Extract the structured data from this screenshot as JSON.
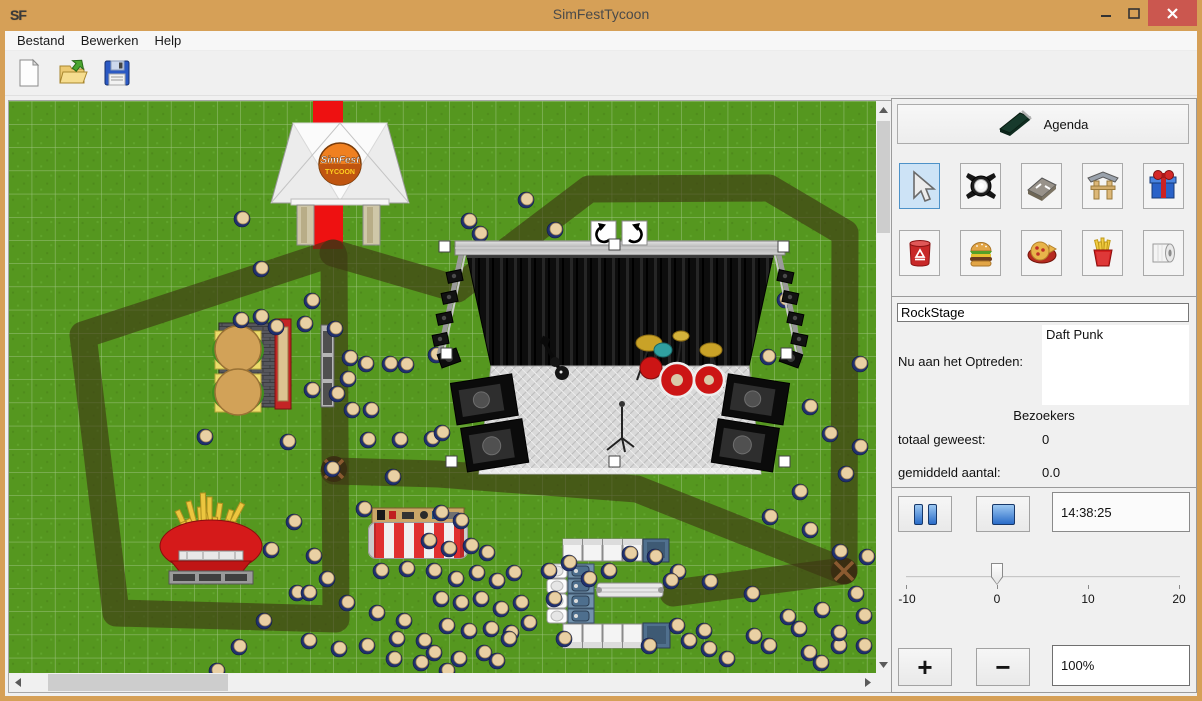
{
  "window": {
    "title": "SimFestTycoon",
    "icon_text": "SF"
  },
  "menu": {
    "items": [
      "Bestand",
      "Bewerken",
      "Help"
    ]
  },
  "toolbar": {
    "buttons": [
      {
        "name": "new-file",
        "icon": "new-document-icon"
      },
      {
        "name": "open-file",
        "icon": "open-folder-icon"
      },
      {
        "name": "save-file",
        "icon": "save-floppy-icon"
      }
    ]
  },
  "panel": {
    "agenda_label": "Agenda",
    "tools": [
      {
        "name": "select",
        "icon": "cursor-icon",
        "selected": true
      },
      {
        "name": "stage-light",
        "icon": "spotlight-icon",
        "selected": false
      },
      {
        "name": "road",
        "icon": "road-tile-icon",
        "selected": false
      },
      {
        "name": "entrance-gate",
        "icon": "gate-icon",
        "selected": false
      },
      {
        "name": "gift",
        "icon": "gift-icon",
        "selected": false
      }
    ],
    "items": [
      {
        "name": "trash-can",
        "icon": "trash-can-icon",
        "selected": false
      },
      {
        "name": "burger-stand",
        "icon": "burger-icon",
        "selected": false
      },
      {
        "name": "pizza-stand",
        "icon": "pizza-icon",
        "selected": false
      },
      {
        "name": "fries-stand",
        "icon": "fries-icon",
        "selected": false
      },
      {
        "name": "toilet",
        "icon": "toilet-roll-icon",
        "selected": false
      }
    ],
    "stage_name_value": "RockStage",
    "now_performing_label": "Nu aan het Optreden:",
    "now_performing_value": "Daft Punk",
    "visitors_header": "Bezoekers",
    "total_label": "totaal geweest:",
    "total_value": "0",
    "average_label": "gemiddeld aantal:",
    "average_value": "0.0",
    "time_value": "14:38:25",
    "slider": {
      "min": -10,
      "max": 20,
      "value": 0,
      "tick_labels": [
        "-10",
        "0",
        "10",
        "20"
      ]
    },
    "zoom_in_label": "+",
    "zoom_out_label": "−",
    "zoom_value": "100%"
  },
  "map": {
    "ground_color": "#55971f",
    "grid_color": "rgba(255,255,255,0.42)",
    "path_color": "rgba(62,54,20,0.62)",
    "carpet": {
      "x": 304,
      "y": 0,
      "w": 30,
      "h": 148,
      "color": "#ee1111"
    },
    "paths": [
      [
        [
          324,
          152
        ],
        [
          74,
          234
        ],
        [
          107,
          512
        ],
        [
          327,
          518
        ],
        [
          325,
          155
        ]
      ],
      [
        [
          324,
          152
        ],
        [
          448,
          188
        ],
        [
          580,
          88
        ],
        [
          760,
          87
        ],
        [
          836,
          132
        ],
        [
          835,
          470
        ]
      ],
      [
        [
          325,
          370
        ],
        [
          430,
          373
        ],
        [
          628,
          388
        ],
        [
          835,
          470
        ]
      ],
      [
        [
          835,
          470
        ],
        [
          664,
          492
        ]
      ]
    ],
    "junctions": [
      [
        325,
        368
      ],
      [
        835,
        470
      ]
    ],
    "tent": {
      "x": 262,
      "y": 18,
      "logo_line1": "SimFest",
      "logo_line2": "TYCOON"
    },
    "stage": {
      "x": 432,
      "y": 115,
      "selected": true
    },
    "burger_stand": {
      "x": 197,
      "y": 215
    },
    "fries_stand": {
      "x": 152,
      "y": 390
    },
    "stall": {
      "x": 359,
      "y": 405
    },
    "toilets": {
      "x": 532,
      "y": 430
    },
    "people": [
      [
        233,
        118
      ],
      [
        252,
        168
      ],
      [
        303,
        200
      ],
      [
        232,
        219
      ],
      [
        252,
        216
      ],
      [
        267,
        226
      ],
      [
        296,
        223
      ],
      [
        326,
        228
      ],
      [
        341,
        257
      ],
      [
        357,
        263
      ],
      [
        381,
        263
      ],
      [
        397,
        264
      ],
      [
        427,
        254
      ],
      [
        303,
        289
      ],
      [
        328,
        293
      ],
      [
        339,
        278
      ],
      [
        362,
        309
      ],
      [
        343,
        309
      ],
      [
        359,
        339
      ],
      [
        196,
        336
      ],
      [
        279,
        341
      ],
      [
        391,
        339
      ],
      [
        423,
        338
      ],
      [
        323,
        368
      ],
      [
        384,
        376
      ],
      [
        433,
        332
      ],
      [
        355,
        408
      ],
      [
        285,
        421
      ],
      [
        305,
        455
      ],
      [
        262,
        449
      ],
      [
        517,
        99
      ],
      [
        546,
        129
      ],
      [
        541,
        159
      ],
      [
        471,
        133
      ],
      [
        699,
        163
      ],
      [
        746,
        191
      ],
      [
        776,
        199
      ],
      [
        681,
        226
      ],
      [
        713,
        249
      ],
      [
        759,
        256
      ],
      [
        851,
        263
      ],
      [
        641,
        281
      ],
      [
        460,
        120
      ],
      [
        801,
        306
      ],
      [
        821,
        333
      ],
      [
        851,
        346
      ],
      [
        837,
        373
      ],
      [
        791,
        391
      ],
      [
        761,
        416
      ],
      [
        801,
        429
      ],
      [
        831,
        451
      ],
      [
        858,
        456
      ],
      [
        847,
        493
      ],
      [
        813,
        509
      ],
      [
        779,
        516
      ],
      [
        743,
        493
      ],
      [
        701,
        481
      ],
      [
        669,
        471
      ],
      [
        646,
        456
      ],
      [
        621,
        453
      ],
      [
        432,
        412
      ],
      [
        452,
        420
      ],
      [
        420,
        440
      ],
      [
        440,
        448
      ],
      [
        462,
        445
      ],
      [
        478,
        452
      ],
      [
        425,
        470
      ],
      [
        447,
        478
      ],
      [
        468,
        472
      ],
      [
        488,
        480
      ],
      [
        505,
        472
      ],
      [
        432,
        498
      ],
      [
        452,
        502
      ],
      [
        472,
        498
      ],
      [
        492,
        508
      ],
      [
        512,
        502
      ],
      [
        438,
        525
      ],
      [
        460,
        530
      ],
      [
        482,
        528
      ],
      [
        502,
        532
      ],
      [
        425,
        552
      ],
      [
        450,
        558
      ],
      [
        475,
        552
      ],
      [
        318,
        478
      ],
      [
        288,
        492
      ],
      [
        338,
        502
      ],
      [
        368,
        512
      ],
      [
        395,
        520
      ],
      [
        415,
        540
      ],
      [
        372,
        470
      ],
      [
        398,
        468
      ],
      [
        255,
        520
      ],
      [
        230,
        546
      ],
      [
        208,
        570
      ],
      [
        300,
        540
      ],
      [
        330,
        548
      ],
      [
        358,
        545
      ],
      [
        385,
        558
      ],
      [
        412,
        562
      ],
      [
        438,
        570
      ],
      [
        300,
        492
      ],
      [
        488,
        560
      ],
      [
        540,
        470
      ],
      [
        560,
        462
      ],
      [
        580,
        478
      ],
      [
        600,
        470
      ],
      [
        545,
        498
      ],
      [
        520,
        522
      ],
      [
        555,
        538
      ],
      [
        500,
        538
      ],
      [
        388,
        538
      ],
      [
        668,
        525
      ],
      [
        695,
        530
      ],
      [
        662,
        480
      ],
      [
        760,
        545
      ],
      [
        800,
        552
      ],
      [
        830,
        545
      ],
      [
        718,
        558
      ],
      [
        680,
        540
      ],
      [
        745,
        535
      ],
      [
        790,
        528
      ],
      [
        830,
        532
      ],
      [
        855,
        515
      ],
      [
        640,
        545
      ],
      [
        700,
        548
      ],
      [
        812,
        562
      ],
      [
        855,
        545
      ]
    ]
  }
}
